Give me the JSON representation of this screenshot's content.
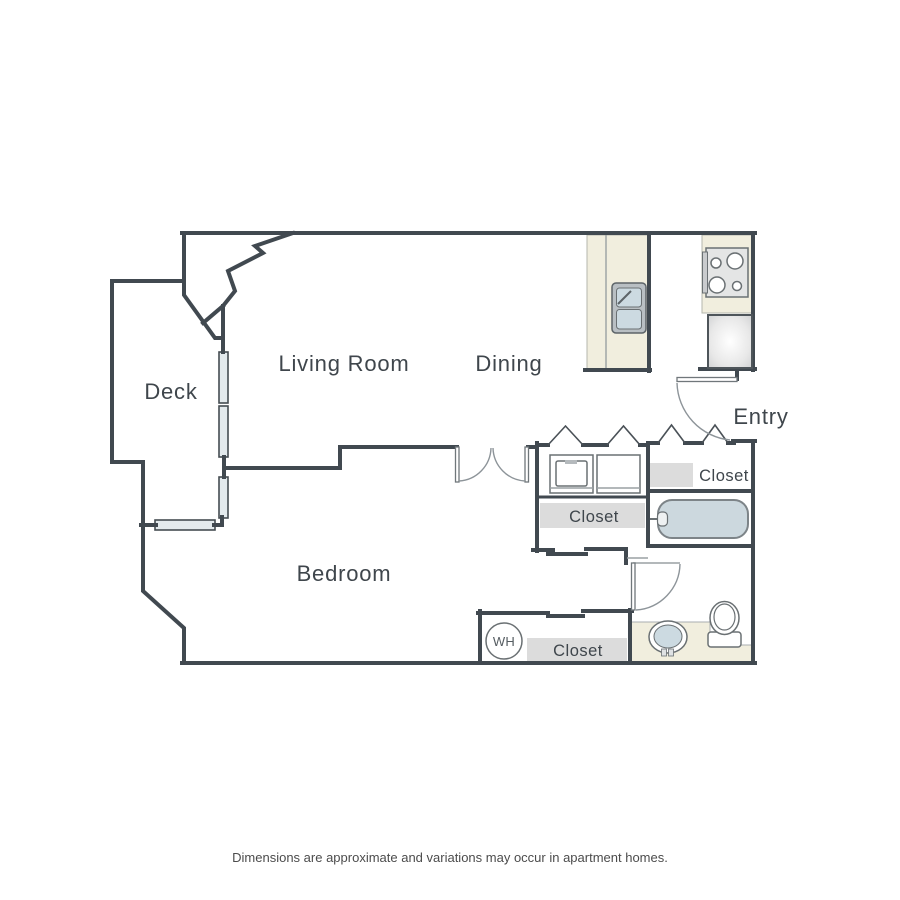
{
  "floorplan": {
    "rooms": {
      "deck": "Deck",
      "living_room": "Living Room",
      "dining": "Dining",
      "entry": "Entry",
      "bedroom": "Bedroom"
    },
    "closets": {
      "entry_closet": "Closet",
      "hall_closet": "Closet",
      "bedroom_closet": "Closet"
    },
    "fixtures": {
      "water_heater": "WH"
    },
    "disclaimer": "Dimensions are approximate and variations may occur in apartment homes.",
    "colors": {
      "wall": "#414950",
      "counter": "#f1eede",
      "closet_shelf": "#dcdcdc",
      "fixture_blue": "#ccdae1",
      "window": "#e3eaed",
      "text": "#3f464c",
      "background": "#ffffff"
    }
  }
}
